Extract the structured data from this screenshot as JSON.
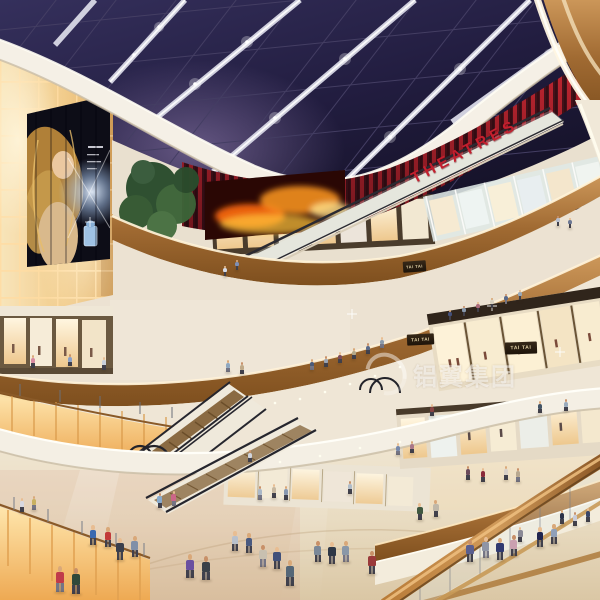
{
  "scene": {
    "description": "architectural rendering of a multi-level shopping mall atrium with glass skylight, escalators and shoppers"
  },
  "signs": {
    "theatres": "THEATRES",
    "store_1": "TAI TAI",
    "store_2": "TAI TAI",
    "store_3": "TAI TAI"
  },
  "watermark": {
    "text": "铝翼集团"
  },
  "palette": {
    "sky": "#221d40",
    "roof_beam": "#e8e8f2",
    "theatre_red": "#c92732",
    "wood": "#a06a32",
    "wall_glow": "#f3cf8f",
    "fascia_cream": "#f5f0e6",
    "fire_screen_orange": "#ff8a1e",
    "floor_beige": "#e6d7bc",
    "watermark_white": "rgba(255,255,255,0.6)"
  },
  "people": [
    [
      225,
      276,
      10,
      "#d8dce6"
    ],
    [
      237,
      270,
      10,
      "#7e8fb5"
    ],
    [
      558,
      226,
      10,
      "#b8bfce"
    ],
    [
      570,
      228,
      10,
      "#6d7894"
    ],
    [
      312,
      370,
      11,
      "#4a5a7a"
    ],
    [
      326,
      367,
      11,
      "#9aa5b5"
    ],
    [
      340,
      363,
      11,
      "#7a4a5a"
    ],
    [
      354,
      359,
      11,
      "#b5a98a"
    ],
    [
      368,
      354,
      11,
      "#5a6a8a"
    ],
    [
      382,
      348,
      11,
      "#8a9aaa"
    ],
    [
      450,
      320,
      10,
      "#44507a"
    ],
    [
      464,
      316,
      10,
      "#8898aa"
    ],
    [
      478,
      312,
      10,
      "#aa6a7a"
    ],
    [
      492,
      308,
      10,
      "#d8d0c0"
    ],
    [
      506,
      304,
      10,
      "#5a6a8a"
    ],
    [
      520,
      300,
      10,
      "#98a8b8"
    ],
    [
      33,
      368,
      13,
      "#d88aa0"
    ],
    [
      70,
      366,
      12,
      "#8aa0c8"
    ],
    [
      104,
      370,
      13,
      "#c8d0dc"
    ],
    [
      228,
      372,
      12,
      "#90a8c0"
    ],
    [
      242,
      374,
      12,
      "#c0aa88"
    ],
    [
      432,
      416,
      12,
      "#884444"
    ],
    [
      540,
      413,
      12,
      "#445566"
    ],
    [
      566,
      411,
      12,
      "#99aabb"
    ],
    [
      398,
      455,
      12,
      "#7788aa"
    ],
    [
      412,
      453,
      12,
      "#aa7788"
    ],
    [
      468,
      480,
      14,
      "#6a4a5a"
    ],
    [
      483,
      482,
      14,
      "#8a2a3a"
    ],
    [
      506,
      480,
      14,
      "#d8d0c8"
    ],
    [
      518,
      482,
      14,
      "#b8a890"
    ],
    [
      520,
      542,
      15,
      "#8a8a96"
    ],
    [
      562,
      524,
      14,
      "#2a3046"
    ],
    [
      575,
      526,
      14,
      "#caccd8"
    ],
    [
      588,
      522,
      14,
      "#3a4668"
    ],
    [
      60,
      592,
      26,
      "#c03a4a"
    ],
    [
      76,
      594,
      26,
      "#30483a"
    ],
    [
      93,
      545,
      20,
      "#3a68b0"
    ],
    [
      108,
      547,
      20,
      "#c23a3a"
    ],
    [
      160,
      508,
      15,
      "#88aacc"
    ],
    [
      174,
      506,
      15,
      "#cc6688"
    ],
    [
      190,
      578,
      24,
      "#6a4fa0"
    ],
    [
      206,
      580,
      24,
      "#3a4048"
    ],
    [
      235,
      551,
      20,
      "#b8c0cc"
    ],
    [
      249,
      553,
      20,
      "#4a5a80"
    ],
    [
      263,
      567,
      22,
      "#c8c0b0"
    ],
    [
      277,
      569,
      22,
      "#40507a"
    ],
    [
      290,
      586,
      26,
      "#556677"
    ],
    [
      318,
      562,
      21,
      "#7a8898"
    ],
    [
      332,
      564,
      22,
      "#2f3846"
    ],
    [
      346,
      562,
      21,
      "#8a98a8"
    ],
    [
      372,
      574,
      23,
      "#9a3a3a"
    ],
    [
      420,
      520,
      17,
      "#405840"
    ],
    [
      436,
      517,
      17,
      "#c0b8a8"
    ],
    [
      470,
      562,
      22,
      "#5a5f8f"
    ],
    [
      486,
      558,
      21,
      "#8f95a5"
    ],
    [
      500,
      560,
      22,
      "#303a70"
    ],
    [
      514,
      556,
      21,
      "#caa0b0"
    ],
    [
      540,
      547,
      20,
      "#20254f"
    ],
    [
      554,
      544,
      20,
      "#90a0b8"
    ],
    [
      260,
      500,
      14,
      "#aab8c8"
    ],
    [
      274,
      498,
      14,
      "#c8b8a0"
    ],
    [
      286,
      500,
      14,
      "#8898b0"
    ],
    [
      350,
      494,
      13,
      "#b0bcc8"
    ],
    [
      22,
      512,
      14,
      "#d8d8e0"
    ],
    [
      34,
      510,
      14,
      "#c8b060"
    ],
    [
      250,
      462,
      12,
      "#d0d4dc"
    ],
    [
      120,
      560,
      22,
      "#3a3f4c"
    ],
    [
      135,
      557,
      21,
      "#8090a8"
    ]
  ]
}
